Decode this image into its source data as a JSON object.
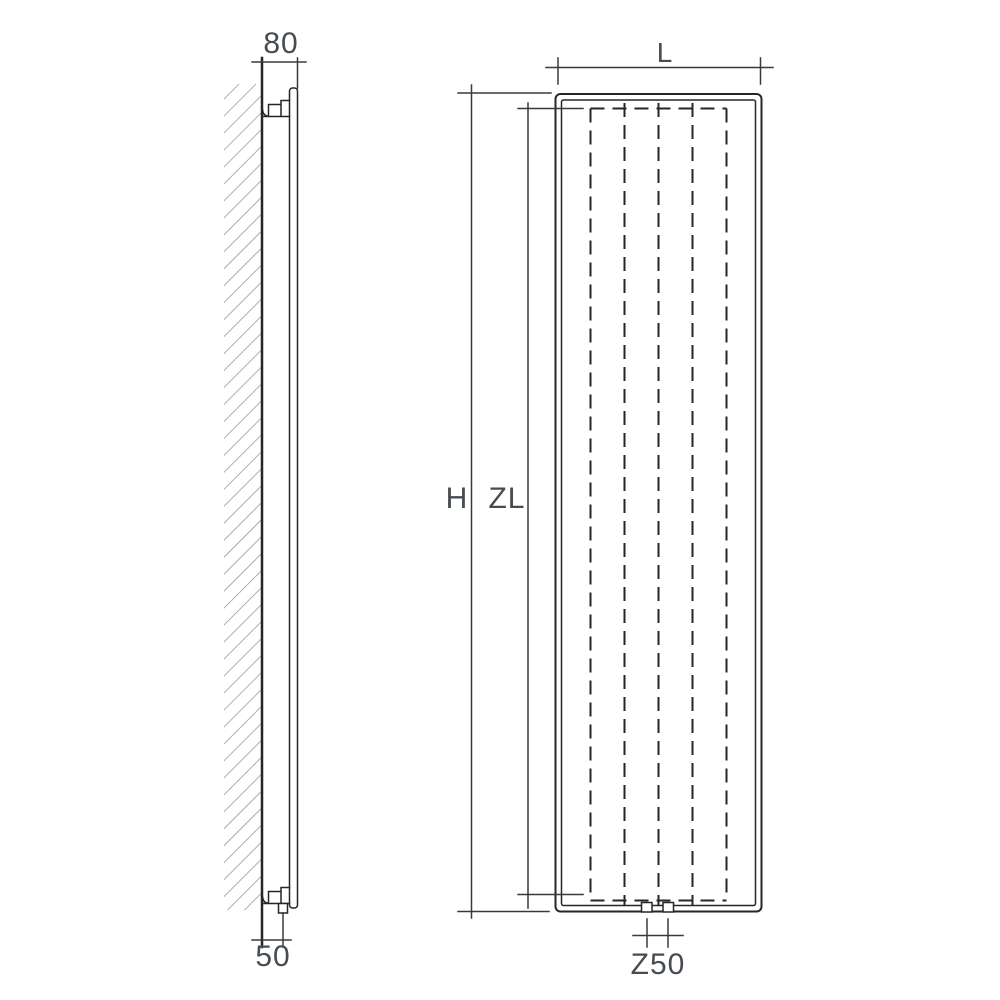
{
  "title": "Vertical radiator technical dimension drawing",
  "views": {
    "side_view": {
      "name": "Side view with wall mounting",
      "dimensions": {
        "depth_from_wall": {
          "label": "80"
        },
        "pipe_offset_from_wall": {
          "label": "50"
        }
      }
    },
    "front_view": {
      "name": "Front view",
      "dimensions": {
        "width": {
          "label": "L"
        },
        "height": {
          "label": "H"
        },
        "zone_length": {
          "label": "ZL"
        },
        "connection_spacing": {
          "label": "Z50"
        }
      }
    }
  },
  "colors": {
    "background": "#ffffff",
    "line": "#262626",
    "dimension_line": "#3a3a3a",
    "hatch": "#8c8c8c",
    "label_text": "#474c52"
  }
}
